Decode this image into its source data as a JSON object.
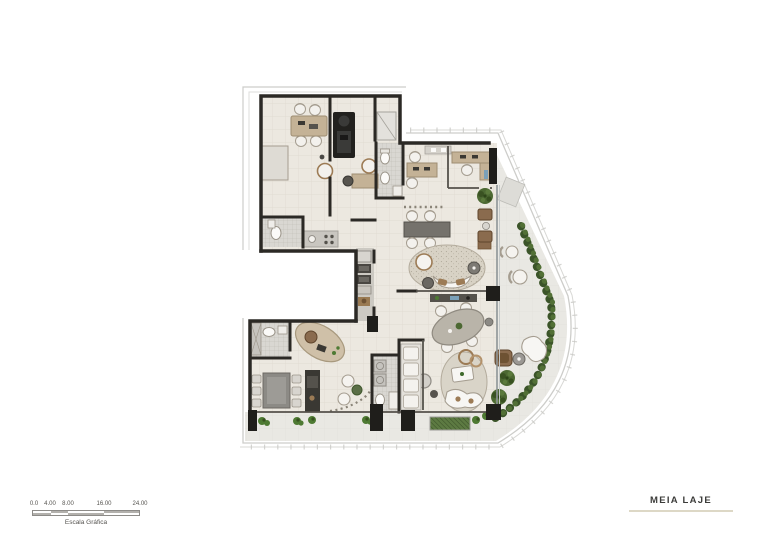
{
  "page": {
    "width": 758,
    "height": 535,
    "background": "#ffffff"
  },
  "plan": {
    "type": "architectural-floor-plan",
    "colors": {
      "wall": "#2b2925",
      "thin_wall": "#55524c",
      "floor": "#ece8e0",
      "tile": "#d9d7d2",
      "balcony": "#e9e8e3",
      "facade_line": "#cdcdca",
      "hedge": "#3b5429",
      "hedge_light": "#527036",
      "bush": "#4e7a33",
      "planter": "#5d7a42",
      "wood": "#c4b296",
      "wood_dark": "#8a6b4e",
      "dark_unit": "#22211e",
      "rug": "#d8d2c5",
      "dark_table": "#75726c",
      "white_furniture": "#f5f3ef",
      "furniture_stroke": "#a59d90",
      "console": "#55524c",
      "glass": "#8e9496"
    }
  },
  "scale_bar": {
    "ticks": [
      "0.0",
      "4.00",
      "8.00",
      "16.00",
      "24.00"
    ],
    "caption": "Escala Gráfica"
  },
  "title_block": {
    "label": "MEIA LAJE"
  }
}
